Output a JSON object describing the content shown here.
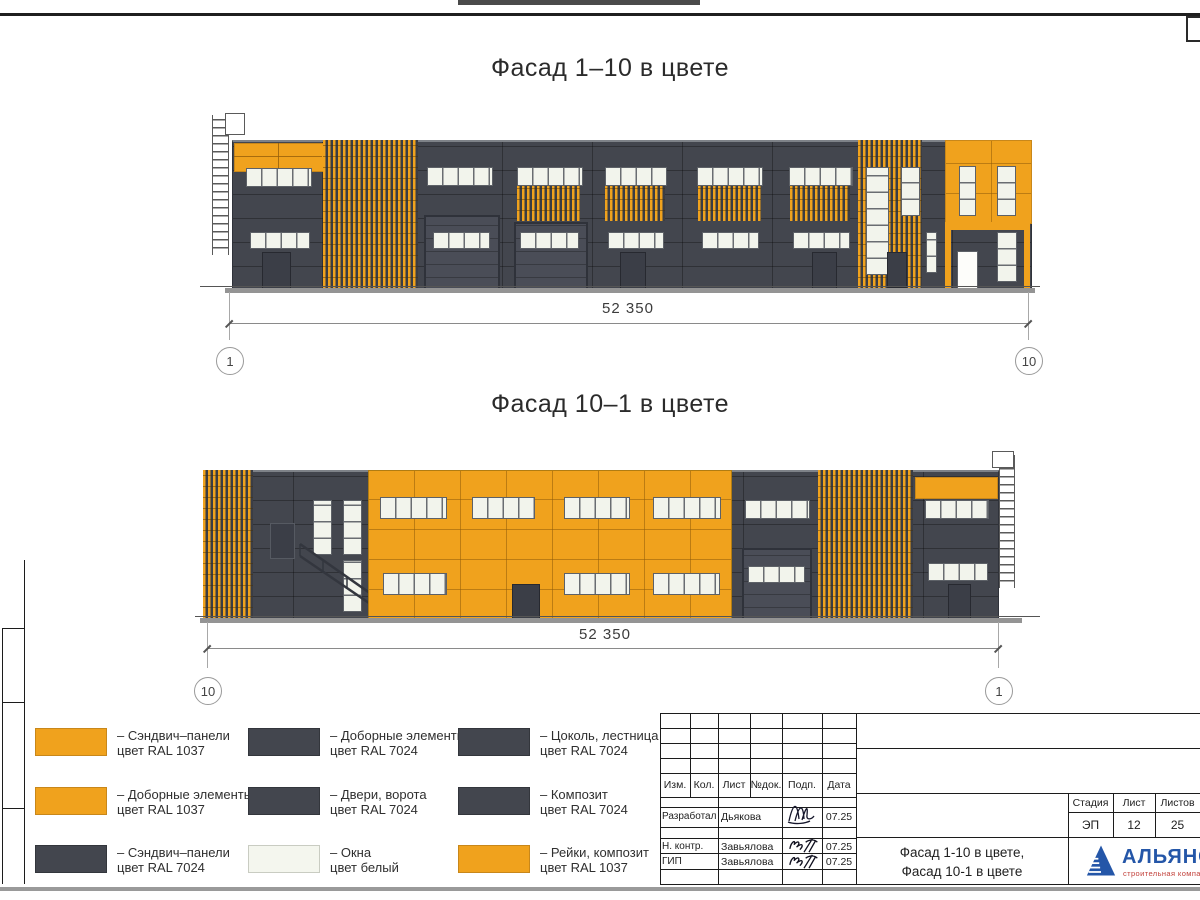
{
  "sheet": {
    "facade_top": {
      "title": "Фасад 1–10 в цвете",
      "dimension": "52 350",
      "axis_left": "1",
      "axis_right": "10"
    },
    "facade_bottom": {
      "title": "Фасад 10–1 в цвете",
      "dimension": "52 350",
      "axis_left": "10",
      "axis_right": "1"
    },
    "legend": {
      "items": [
        {
          "swatch": "orange",
          "line1": "– Сэндвич–панели",
          "line2": "цвет RAL 1037"
        },
        {
          "swatch": "orange",
          "line1": "– Доборные элементы",
          "line2": "цвет RAL 1037"
        },
        {
          "swatch": "dark",
          "line1": "– Сэндвич–панели",
          "line2": "цвет RAL 7024"
        },
        {
          "swatch": "dark",
          "line1": "– Доборные элементы",
          "line2": "цвет RAL 7024"
        },
        {
          "swatch": "dark",
          "line1": "– Двери, ворота",
          "line2": "цвет RAL 7024"
        },
        {
          "swatch": "window",
          "line1": "– Окна",
          "line2": "цвет белый"
        },
        {
          "swatch": "dark",
          "line1": "– Цоколь, лестница",
          "line2": "цвет RAL 7024"
        },
        {
          "swatch": "dark",
          "line1": "– Композит",
          "line2": "цвет RAL 7024"
        },
        {
          "swatch": "orange",
          "line1": "– Рейки, композит",
          "line2": "цвет RAL 1037"
        }
      ]
    },
    "title_block": {
      "columns": [
        "Изм.",
        "Кол.",
        "Лист",
        "№док.",
        "Подп.",
        "Дата"
      ],
      "signature_rows": [
        {
          "role": "Разработал",
          "name": "Дьякова",
          "date": "07.25"
        },
        {
          "role": "Н. контр.",
          "name": "Завьялова",
          "date": "07.25"
        },
        {
          "role": "ГИП",
          "name": "Завьялова",
          "date": "07.25"
        }
      ],
      "stage_label": "Стадия",
      "sheet_label": "Лист",
      "sheets_label": "Листов",
      "stage_value": "ЭП",
      "sheet_value": "12",
      "sheets_value": "25",
      "doc_title_line1": "Фасад 1-10 в цвете,",
      "doc_title_line2": "Фасад 10-1 в цвете",
      "company_name": "АЛЬЯНС",
      "company_tagline": "строительная компания"
    },
    "colors": {
      "orange_ral1037": "#F0A21D",
      "dark_ral7024": "#43464E",
      "window_white": "#F2F4EC",
      "logo_blue": "#2456A8",
      "logo_red": "#C2403A"
    }
  }
}
